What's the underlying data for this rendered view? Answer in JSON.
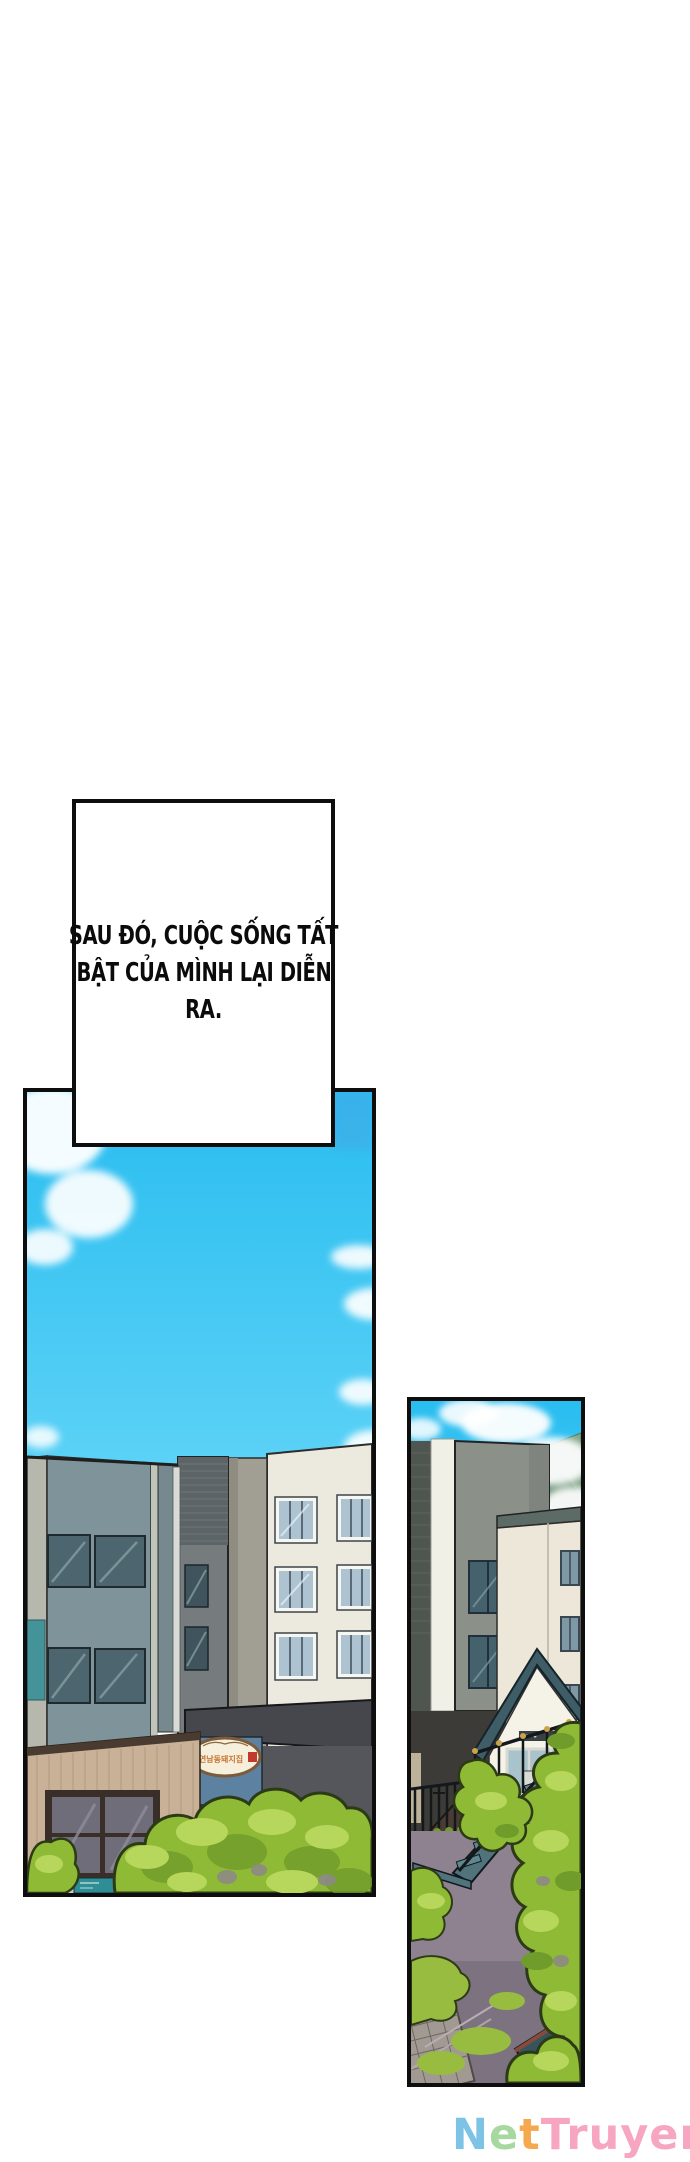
{
  "narration": {
    "lines": [
      "SAU ĐÓ, CUỘC SỐNG TẤT",
      "BẬT CỦA MÌNH LẠI DIỄN",
      "RA."
    ]
  },
  "left_panel": {
    "shop_sign_text": "연남동돼지집"
  },
  "watermark": {
    "text": "NetTruyen",
    "letters": [
      {
        "ch": "N",
        "color": "#7cc3e6"
      },
      {
        "ch": "e",
        "color": "#a6d8a0"
      },
      {
        "ch": "t",
        "color": "#f4a94f"
      },
      {
        "ch": "T",
        "color": "#f7a6c1"
      },
      {
        "ch": "r",
        "color": "#f7a6c1"
      },
      {
        "ch": "u",
        "color": "#f7a6c1"
      },
      {
        "ch": "y",
        "color": "#f7a6c1"
      },
      {
        "ch": "e",
        "color": "#f7a6c1"
      },
      {
        "ch": "n",
        "color": "#f7a6c1"
      }
    ]
  },
  "palette": {
    "border": "#0e0e0e",
    "ink": "#0b0b0b",
    "sky_top": "#29bdf0",
    "sky_low": "#62d4f7",
    "cloud": "#ffffff",
    "slate_face": "#7e939a",
    "slate_face2": "#75898f",
    "light_col": "#b6b8ad",
    "divider": "#c2c6ba",
    "win_dark": "#4d656e",
    "win_streak": "#8da4ab",
    "tower_brick": "#5d6468",
    "tower_face": "#767c7e",
    "tower_win": "#3f545c",
    "side_wall": "#a19f93",
    "cream": "#ece9de",
    "cream_win_glass": "#aec3d1",
    "cream_win_frame": "#f7f7f2",
    "cream_mullion": "#5a6a76",
    "awning": "#46474c",
    "lower_wall": "#54565b",
    "sign_band": "#5d82a1",
    "sign_bg": "#f6efdc",
    "sign_rim": "#7c5a3a",
    "sign_text_color": "#c7742f",
    "stamp_red": "#c03b2d",
    "wood": "#c9b197",
    "wood_line": "#b29a7f",
    "wood_roof": "#4a3b30",
    "shop_frame": "#3a2e28",
    "shop_glass": "#6f6d79",
    "sidewalk": "#cfc9bf",
    "teal_sign": "#2f8d95",
    "tree_base": "#8fba36",
    "tree_hi": "#b7d75c",
    "tree_dk": "#6f9c2a",
    "tree_outline": "#2c3a16",
    "trunk": "#8d8a84",
    "gray_face": "#8b9089",
    "gray_brick": "#4f554f",
    "stripe": "#f0f0e6",
    "mountain": "#7fa687",
    "roof_band": "#5c6b66",
    "cream2": "#ece7d8",
    "house_roof": "#3f5d66",
    "house_wall": "#f5f2e8",
    "house_glass": "#a9c3cc",
    "rail_black": "#14181b",
    "stair_teal": "#5f8790",
    "stringer": "#51747c",
    "shed": "#4a3c34",
    "fence_wood": "#6f5141",
    "crate": "#3a7a4e",
    "ground": "#8e8290",
    "asphalt": "#7d7380",
    "moss": "#97bc3f",
    "cobble": "#a09a92",
    "teal_roof": "#35555e",
    "teal_roof_edge": "#8a4a3a",
    "pillar": "#d9dcd6",
    "dark_base": "#3c3b37"
  }
}
